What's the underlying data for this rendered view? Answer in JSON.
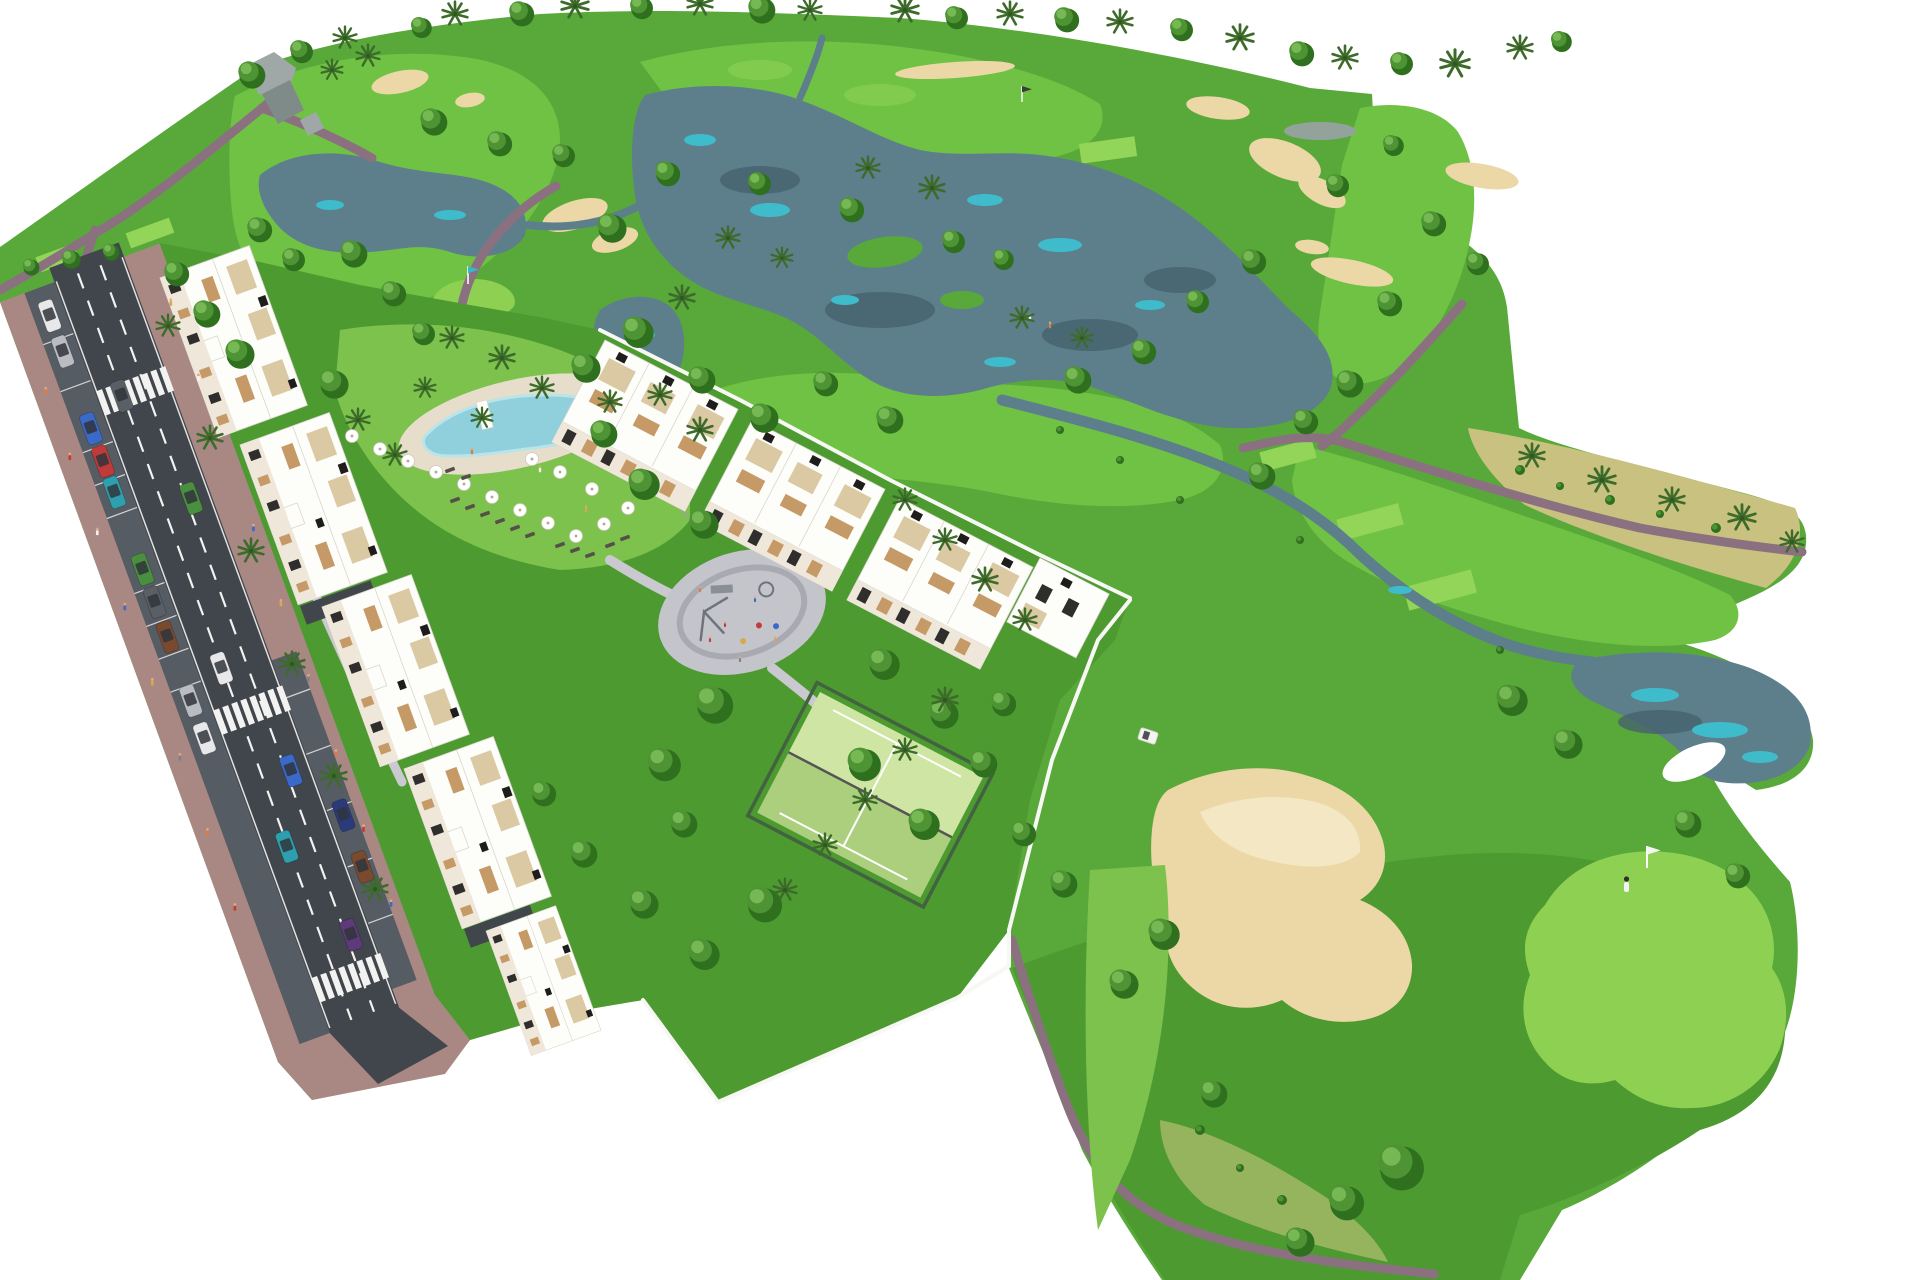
{
  "scene": {
    "title": "Aerial 3D architectural rendering of a golf resort residential development",
    "features": [
      "golf course",
      "lakes and streams",
      "sand bunkers",
      "putting greens with flags",
      "white apartment buildings with roof terraces",
      "lagoon swimming pool with umbrellas",
      "playground",
      "padel court",
      "access road with crosswalks and parked cars",
      "palm trees",
      "golf cart",
      "pedestrians"
    ]
  },
  "colors": {
    "white": "#ffffff",
    "rough": "#58a93a",
    "roughDark": "#4d9a31",
    "fairway": "#70c244",
    "tee": "#92d558",
    "green": "#8ed152",
    "lawn": "#7cc24c",
    "dryGrass": "#c8c17f",
    "dryGreen": "#a9b96a",
    "sand": "#ecd8a6",
    "sandLight": "#f4e7c3",
    "water": "#5d7f8c",
    "waterHighlight": "#3fbccb",
    "waterGray": "#93a39b",
    "waterReflection": "#46626e",
    "path": "#8b7180",
    "walkway": "#c9c9cf",
    "playground": "#c4c4cb",
    "playgroundRing": "#a9a9b2",
    "equipment": "#6f747b",
    "asphalt": "#41464c",
    "parkingLane": "#565c63",
    "roadLine": "#f2f2f0",
    "sidewalk": "#a98884",
    "building": "#fdfdfa",
    "buildingEdge": "#d9d6cd",
    "facade": "#efe8da",
    "terrace": "#dbc9a4",
    "wood": "#c69a66",
    "window": "#2f2e2c",
    "roofUnit": "#1e1d1b",
    "pool": "#8fd0dc",
    "poolLight": "#b8e4ea",
    "poolDeck": "#e7ddcb",
    "court": "#abcf7d",
    "courtLight": "#cfe5a4",
    "fence": "#42633f",
    "fenceLight": "#9aa59a",
    "wallWhite": "#f7f7f4",
    "rock": "#9fa8a6",
    "rockDark": "#7f8b89",
    "treeDark": "#2f701f",
    "treeMid": "#4e9434",
    "treeLight": "#76b954",
    "palm": "#3d6b2a",
    "palmDark": "#2f5722",
    "umbrella": "#ffffff",
    "umbrellaRim": "#cfc9bd",
    "umbrellaPole": "#b5a98f",
    "skin": "#e5a87e",
    "carGlass": "#30353b",
    "cart": "#f4f4f0",
    "pinPole": "#fafafa",
    "flagTeal": "#35b9c6",
    "flagWhite": "#f5f5f5",
    "flagDark": "#3c3c3c",
    "loungerColor": "#57504a"
  },
  "cars": [
    "#e8e8ea",
    "#b9bdc2",
    "#3a69c7",
    "#c03a3a",
    "#2e9fae",
    "#4a8f3f",
    "#5a5f66",
    "#2b3a7a",
    "#7a4a2f",
    "#5d3b7a"
  ],
  "peopleColors": [
    "#d97b4a",
    "#c23b3b",
    "#f2f2f2",
    "#3a69c7",
    "#d9a84a",
    "#7d8289"
  ]
}
